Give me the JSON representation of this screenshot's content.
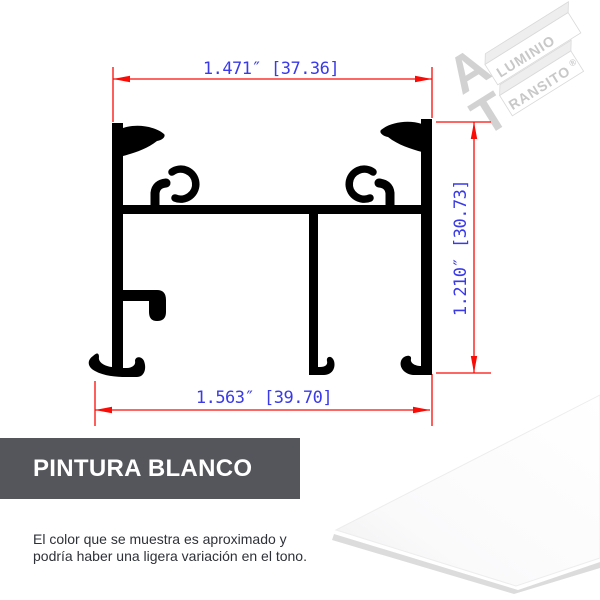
{
  "drawing": {
    "dimensions": {
      "top": {
        "label": "1.471″ [37.36]",
        "inches": "1.471″",
        "millimeters": "37.36"
      },
      "right": {
        "label": "1.210″ [30.73]",
        "inches": "1.210″",
        "millimeters": "30.73"
      },
      "bottom": {
        "label": "1.563″ [39.70]",
        "inches": "1.563″",
        "millimeters": "39.70"
      }
    },
    "colors": {
      "dimension_lines": "#f90b06",
      "dimension_text": "#3a3ae8",
      "profile": "#000000"
    }
  },
  "watermark": {
    "word1": {
      "initial": "A",
      "rest": "LUMINIO"
    },
    "word2": {
      "initial": "T",
      "rest": "RANSITO"
    },
    "registered_mark": "®",
    "color": "#d2d2d3"
  },
  "finish": {
    "banner_label": "PINTURA BLANCO",
    "banner_bg": "#54565b",
    "swatch_color": "#ffffff"
  },
  "disclaimer": {
    "line1": "El color que se muestra es aproximado y",
    "line2": "podría haber una ligera variación en el tono."
  }
}
